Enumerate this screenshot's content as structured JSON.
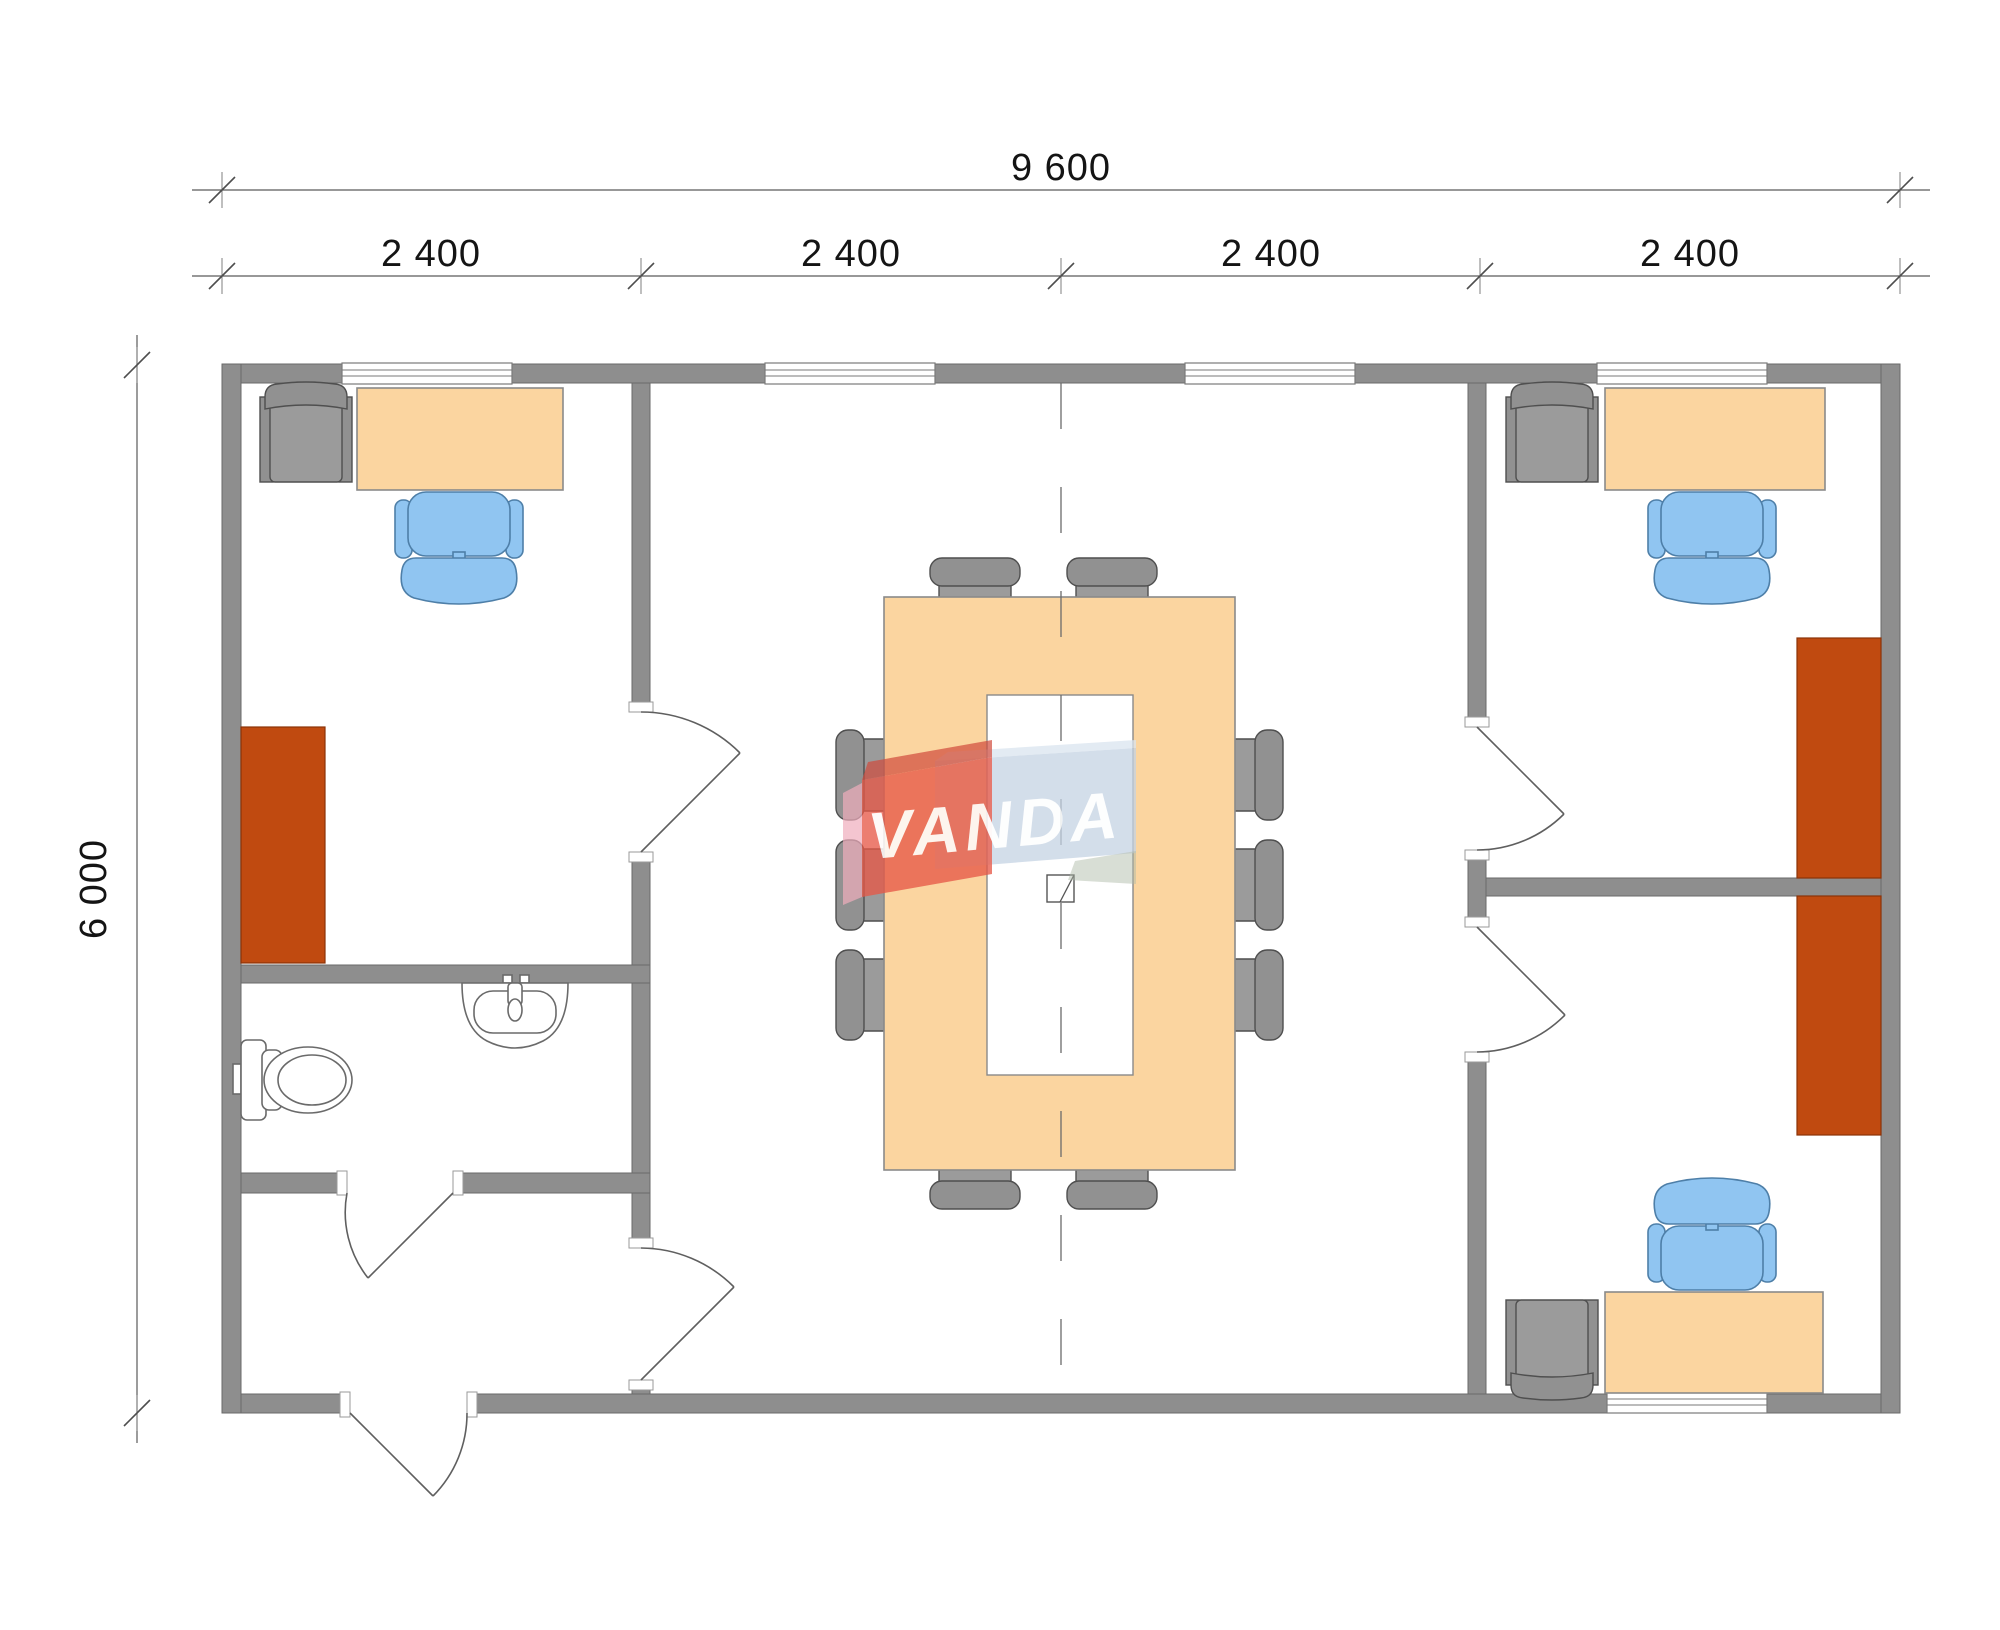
{
  "dimensions": {
    "total_width_label": "9 600",
    "module_labels": [
      "2 400",
      "2 400",
      "2 400",
      "2 400"
    ],
    "height_label": "6 000"
  },
  "watermark": {
    "text": "VANDA",
    "red": "#E65847",
    "blue": "#C4D2E3",
    "pink": "#F0AEBD",
    "text_color": "#FFFFFF"
  },
  "colors": {
    "wall": "#8E8E8E",
    "wall_outline": "#6A6A6A",
    "desk_and_table": "#FBD5A0",
    "office_chair_blue": "#90C5F1",
    "chair_gray": "#919191",
    "cabinet_brown": "#C04A10",
    "dimension_text": "#141414",
    "dimension_line": "#5A5A5A"
  },
  "furniture_counts": {
    "desks": 3,
    "blue_office_chairs": 3,
    "gray_guest_chairs": 3,
    "conference_chairs": 10,
    "brown_cabinets": 3,
    "toilets": 1,
    "sinks": 1,
    "windows": 5,
    "doors": 6
  }
}
